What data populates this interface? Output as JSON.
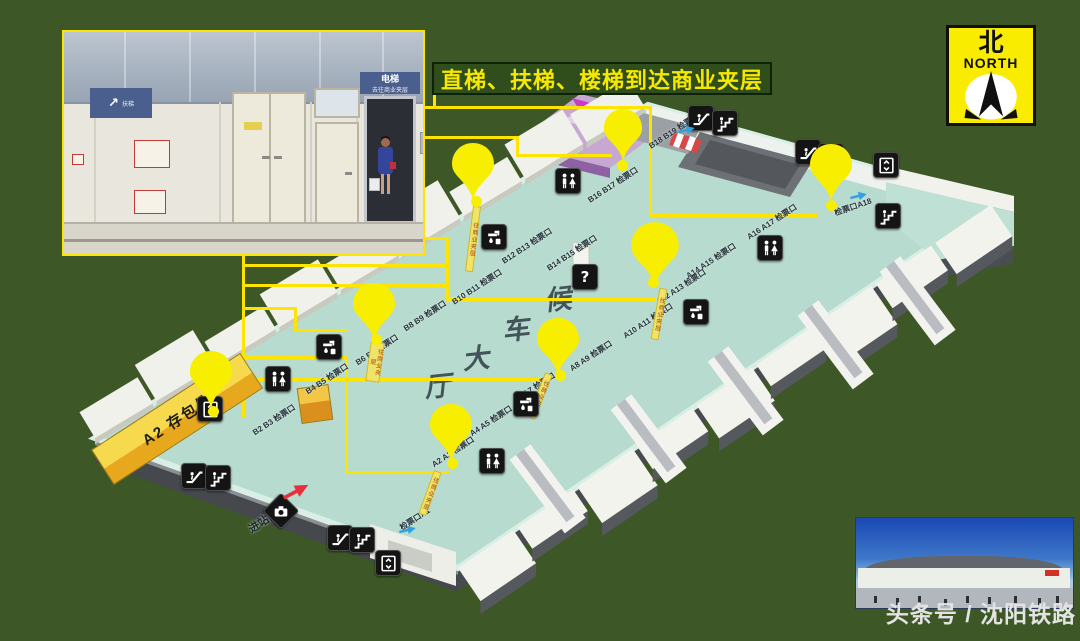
{
  "banner": {
    "text": "直梯、扶梯、楼梯到达商业夹层"
  },
  "compass": {
    "hanzi": "北",
    "label": "NORTH"
  },
  "watermark": {
    "text": "头条号 / 沈阳铁路"
  },
  "inset": {
    "escalator_sign": {
      "arrow": "↗",
      "line1": "扶梯"
    },
    "elevator_sign": {
      "line1": "电梯",
      "line2": "去往商业夹层"
    }
  },
  "map": {
    "hall_chars": [
      "候",
      "车",
      "大",
      "厅"
    ],
    "info_symbol": "?",
    "balloon_strip_text": "往商业夹层",
    "entrance_label": "进站口A2",
    "storage_label": "A2 存包处",
    "gates": [
      {
        "label": "B18 B19 检票口"
      },
      {
        "label": "B16 B17 检票口"
      },
      {
        "label": "B14 B15 检票口"
      },
      {
        "label": "B12 B13 检票口"
      },
      {
        "label": "B10 B11 检票口"
      },
      {
        "label": "B8 B9 检票口"
      },
      {
        "label": "B6 B7 检票口"
      },
      {
        "label": "B4 B5 检票口"
      },
      {
        "label": "B2 B3 检票口"
      },
      {
        "label": "检票口A18"
      },
      {
        "label": "A16 A17 检票口"
      },
      {
        "label": "A14 A15 检票口"
      },
      {
        "label": "A12 A13 检票口"
      },
      {
        "label": "A10 A11 检票口"
      },
      {
        "label": "A8 A9 检票口"
      },
      {
        "label": "A6 A7 检票口"
      },
      {
        "label": "A4 A5 检票口"
      },
      {
        "label": "A2 A3 检票口"
      },
      {
        "label": "检票口A1"
      }
    ]
  }
}
